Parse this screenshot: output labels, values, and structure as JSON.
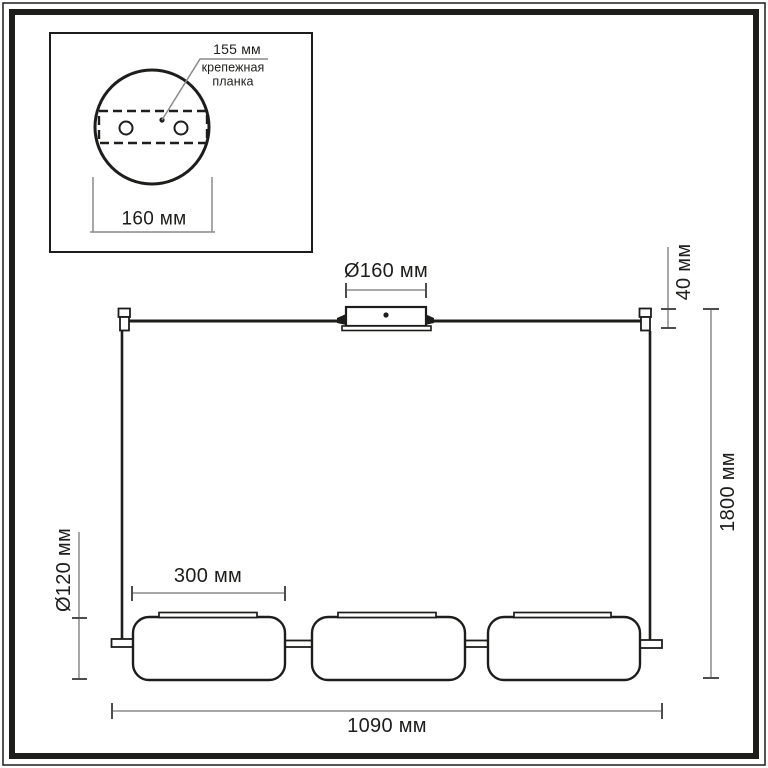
{
  "colors": {
    "line": "#1d1d1b",
    "dimension": "#8a8a8a",
    "tick": "#4d4d4d",
    "background": "#ffffff"
  },
  "inset": {
    "hole_spacing": "155 мм",
    "mount_plate_line1": "крепежная",
    "mount_plate_line2": "планка",
    "canopy_diameter": "160 мм"
  },
  "main": {
    "canopy_diameter": "Ø160 мм",
    "canopy_height": "40 мм",
    "overall_height": "1800 мм",
    "shade_height": "Ø120 мм",
    "shade_width": "300 мм",
    "overall_width": "1090 мм"
  }
}
